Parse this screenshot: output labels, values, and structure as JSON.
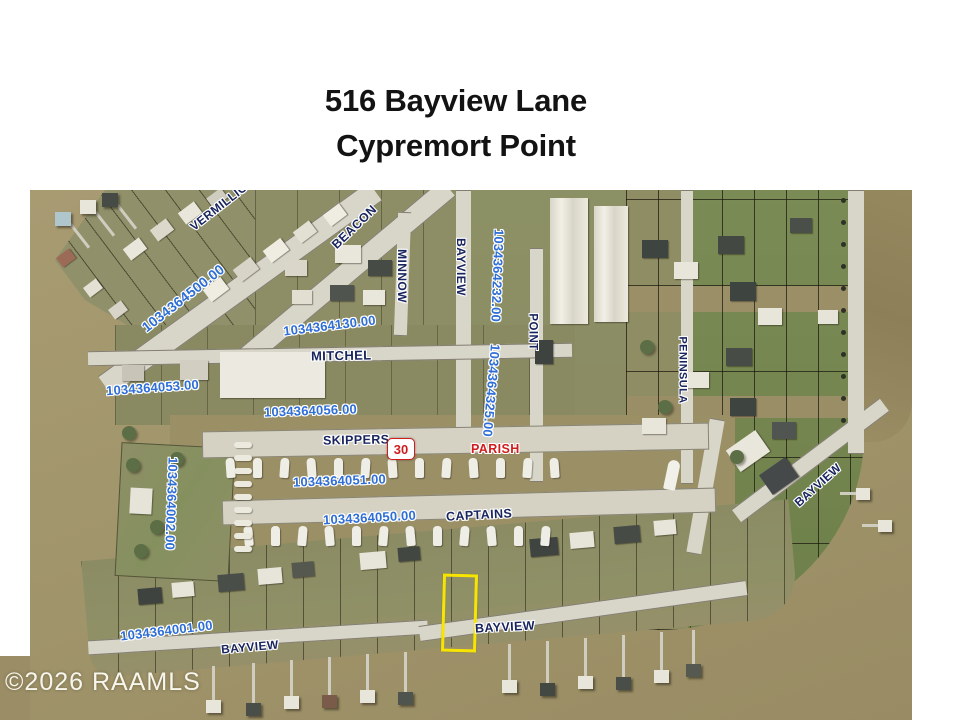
{
  "title": {
    "line1": "516 Bayview Lane",
    "line2": "Cypremort Point"
  },
  "map": {
    "watermark": "©2026 RAAMLS",
    "route_shield": {
      "number": "30"
    },
    "colors": {
      "parcel_number": "#2e6ed6",
      "street_label": "#18245e",
      "highlight": "#f7e500",
      "route_red": "#cf1d1d",
      "water": "#a3976d"
    },
    "street_labels": [
      {
        "name": "vermillion",
        "text": "VERMILLION B"
      },
      {
        "name": "beacon",
        "text": "BEACON"
      },
      {
        "name": "minnow",
        "text": "MINNOW"
      },
      {
        "name": "bayview-north",
        "text": "BAYVIEW"
      },
      {
        "name": "point",
        "text": "POINT"
      },
      {
        "name": "mitchel",
        "text": "MITCHEL"
      },
      {
        "name": "skippers",
        "text": "SKIPPERS"
      },
      {
        "name": "parish",
        "text": "PARISH"
      },
      {
        "name": "captains",
        "text": "CAPTAINS"
      },
      {
        "name": "peninsula",
        "text": "PENINSULA"
      },
      {
        "name": "bayview-east",
        "text": "BAYVIEW"
      },
      {
        "name": "bayview-south-west",
        "text": "BAYVIEW"
      },
      {
        "name": "bayview-south",
        "text": "BAYVIEW"
      }
    ],
    "parcel_numbers": [
      {
        "name": "1034364500",
        "text": "1034364500.00"
      },
      {
        "name": "1034364130",
        "text": "1034364130.00"
      },
      {
        "name": "1034364232",
        "text": "1034364232.00"
      },
      {
        "name": "1034364053",
        "text": "1034364053.00"
      },
      {
        "name": "1034364056",
        "text": "1034364056.00"
      },
      {
        "name": "1034364325",
        "text": "1034364325.00"
      },
      {
        "name": "1034364051",
        "text": "1034364051.00"
      },
      {
        "name": "1034364050",
        "text": "1034364050.00"
      },
      {
        "name": "1034364002",
        "text": "1034364002.00"
      },
      {
        "name": "1034364001",
        "text": "1034364001.00"
      }
    ]
  }
}
